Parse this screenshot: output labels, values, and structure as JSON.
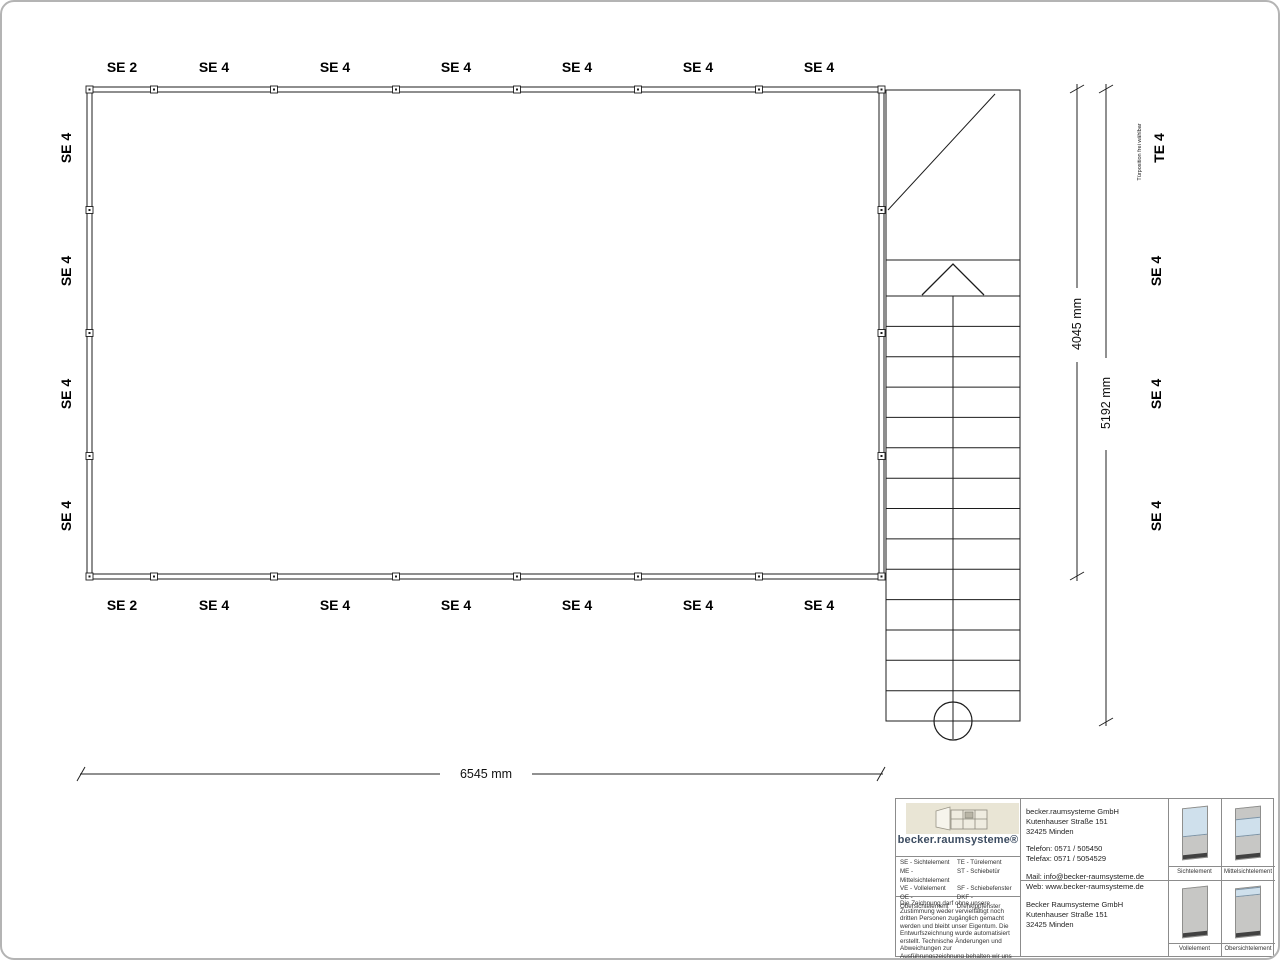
{
  "drawing": {
    "top_labels": [
      "SE 2",
      "SE 4",
      "SE 4",
      "SE 4",
      "SE 4",
      "SE 4",
      "SE 4"
    ],
    "bottom_labels": [
      "SE 2",
      "SE 4",
      "SE 4",
      "SE 4",
      "SE 4",
      "SE 4",
      "SE 4"
    ],
    "left_labels": [
      "SE 4",
      "SE 4",
      "SE 4",
      "SE 4"
    ],
    "right_labels": [
      "TE 4",
      "SE 4",
      "SE 4",
      "SE 4"
    ],
    "door_note": "Türposition frei wählbar",
    "dimensions": {
      "width": "6545 mm",
      "height_room": "4045 mm",
      "height_total": "5192 mm"
    }
  },
  "titleblock": {
    "logo_text": "becker.raumsysteme®",
    "legend": [
      [
        "SE - Sichtelement",
        "TE - Türelement"
      ],
      [
        "ME - Mittelsichtelement",
        "ST - Schiebetür"
      ],
      [
        "VE - Vollelement",
        "SF - Schiebefenster"
      ],
      [
        "OE - Obersichtelement",
        "DKF - Drehkippfenster"
      ]
    ],
    "copyright": "Die Zeichnung darf ohne unsere Zustimmung weder vervielfältigt noch dritten Personen zugänglich gemacht werden und bleibt unser Eigentum. Die Entwurfszeichnung wurde automatisiert erstellt. Technische Änderungen und Abweichungen zur Ausführungszeichnung behalten wir uns vor.",
    "address_top": [
      "becker.raumsysteme GmbH",
      "Kutenhauser Straße 151",
      "32425 Minden"
    ],
    "phone": [
      "Telefon: 0571 / 505450",
      "Telefax: 0571 / 5054529"
    ],
    "web": [
      "Mail: info@becker-raumsysteme.de",
      "Web: www.becker-raumsysteme.de"
    ],
    "address_bottom": [
      "Becker Raumsysteme GmbH",
      "Kutenhauser Straße 151",
      "32425 Minden"
    ],
    "elements": [
      {
        "caption": "Sichtelement"
      },
      {
        "caption": "Mittelsichtelement"
      },
      {
        "caption": "Vollelement"
      },
      {
        "caption": "Obersichtelement"
      }
    ]
  },
  "colors": {
    "line": "#1c1c1c",
    "logo_navy": "#3c4c61",
    "logo_beige": "#e9e5d5",
    "glass_blue": "#cfe0ec",
    "panel_grey": "#c7c7c5",
    "panel_base": "#414141"
  }
}
